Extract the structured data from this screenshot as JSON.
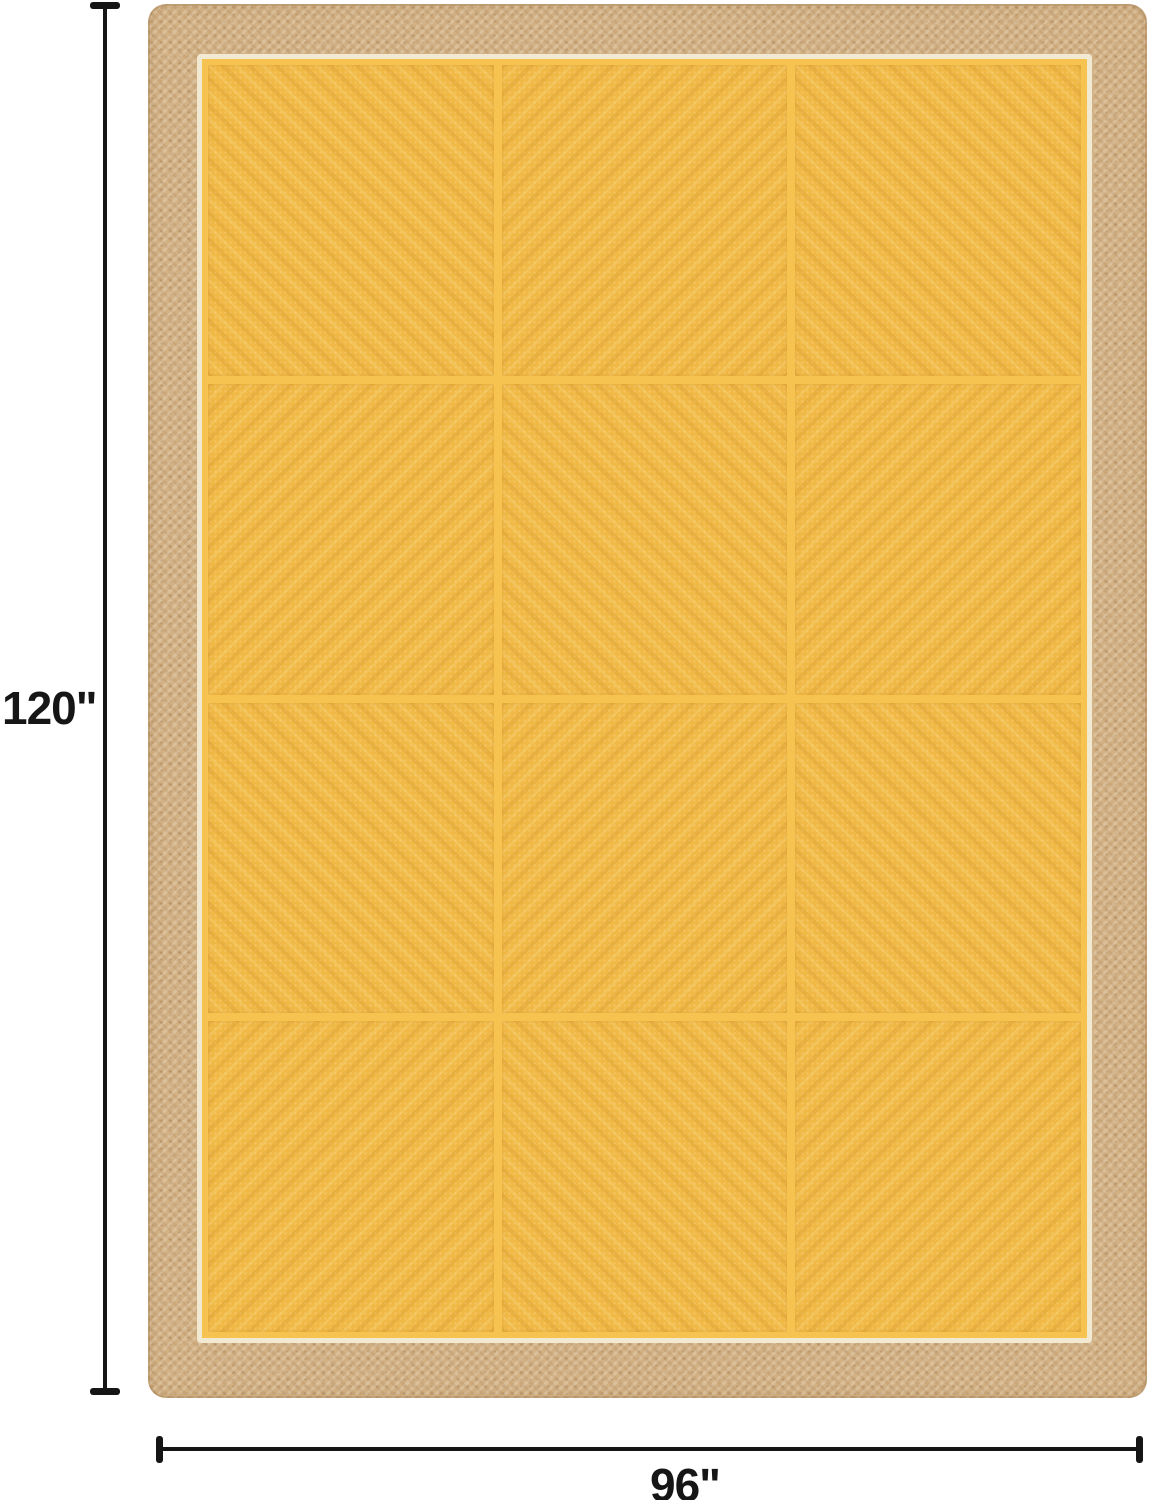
{
  "page": {
    "background_color": "#ffffff",
    "description": "Product dimension image of a yellow braided jute area rug with natural tan border"
  },
  "dimensions": {
    "height_label": "120\"",
    "width_label": "96\"",
    "line_color": "#151515",
    "label_color": "#161616"
  },
  "rug": {
    "description": "yellow patchwork jute rug with diagonal weave squares, natural braided border and cream trim",
    "border_color": "#d2b184",
    "trim_color": "#f2e9d3",
    "field_color": "#f0b946",
    "grid_line_color": "#f6c350",
    "rows": 4,
    "cols": 3,
    "cells": [
      {
        "stripe_angle": 45
      },
      {
        "stripe_angle": 135
      },
      {
        "stripe_angle": 45
      },
      {
        "stripe_angle": 135
      },
      {
        "stripe_angle": 45
      },
      {
        "stripe_angle": 135
      },
      {
        "stripe_angle": 45
      },
      {
        "stripe_angle": 135
      },
      {
        "stripe_angle": 45
      },
      {
        "stripe_angle": 135
      },
      {
        "stripe_angle": 45
      },
      {
        "stripe_angle": 135
      }
    ]
  }
}
